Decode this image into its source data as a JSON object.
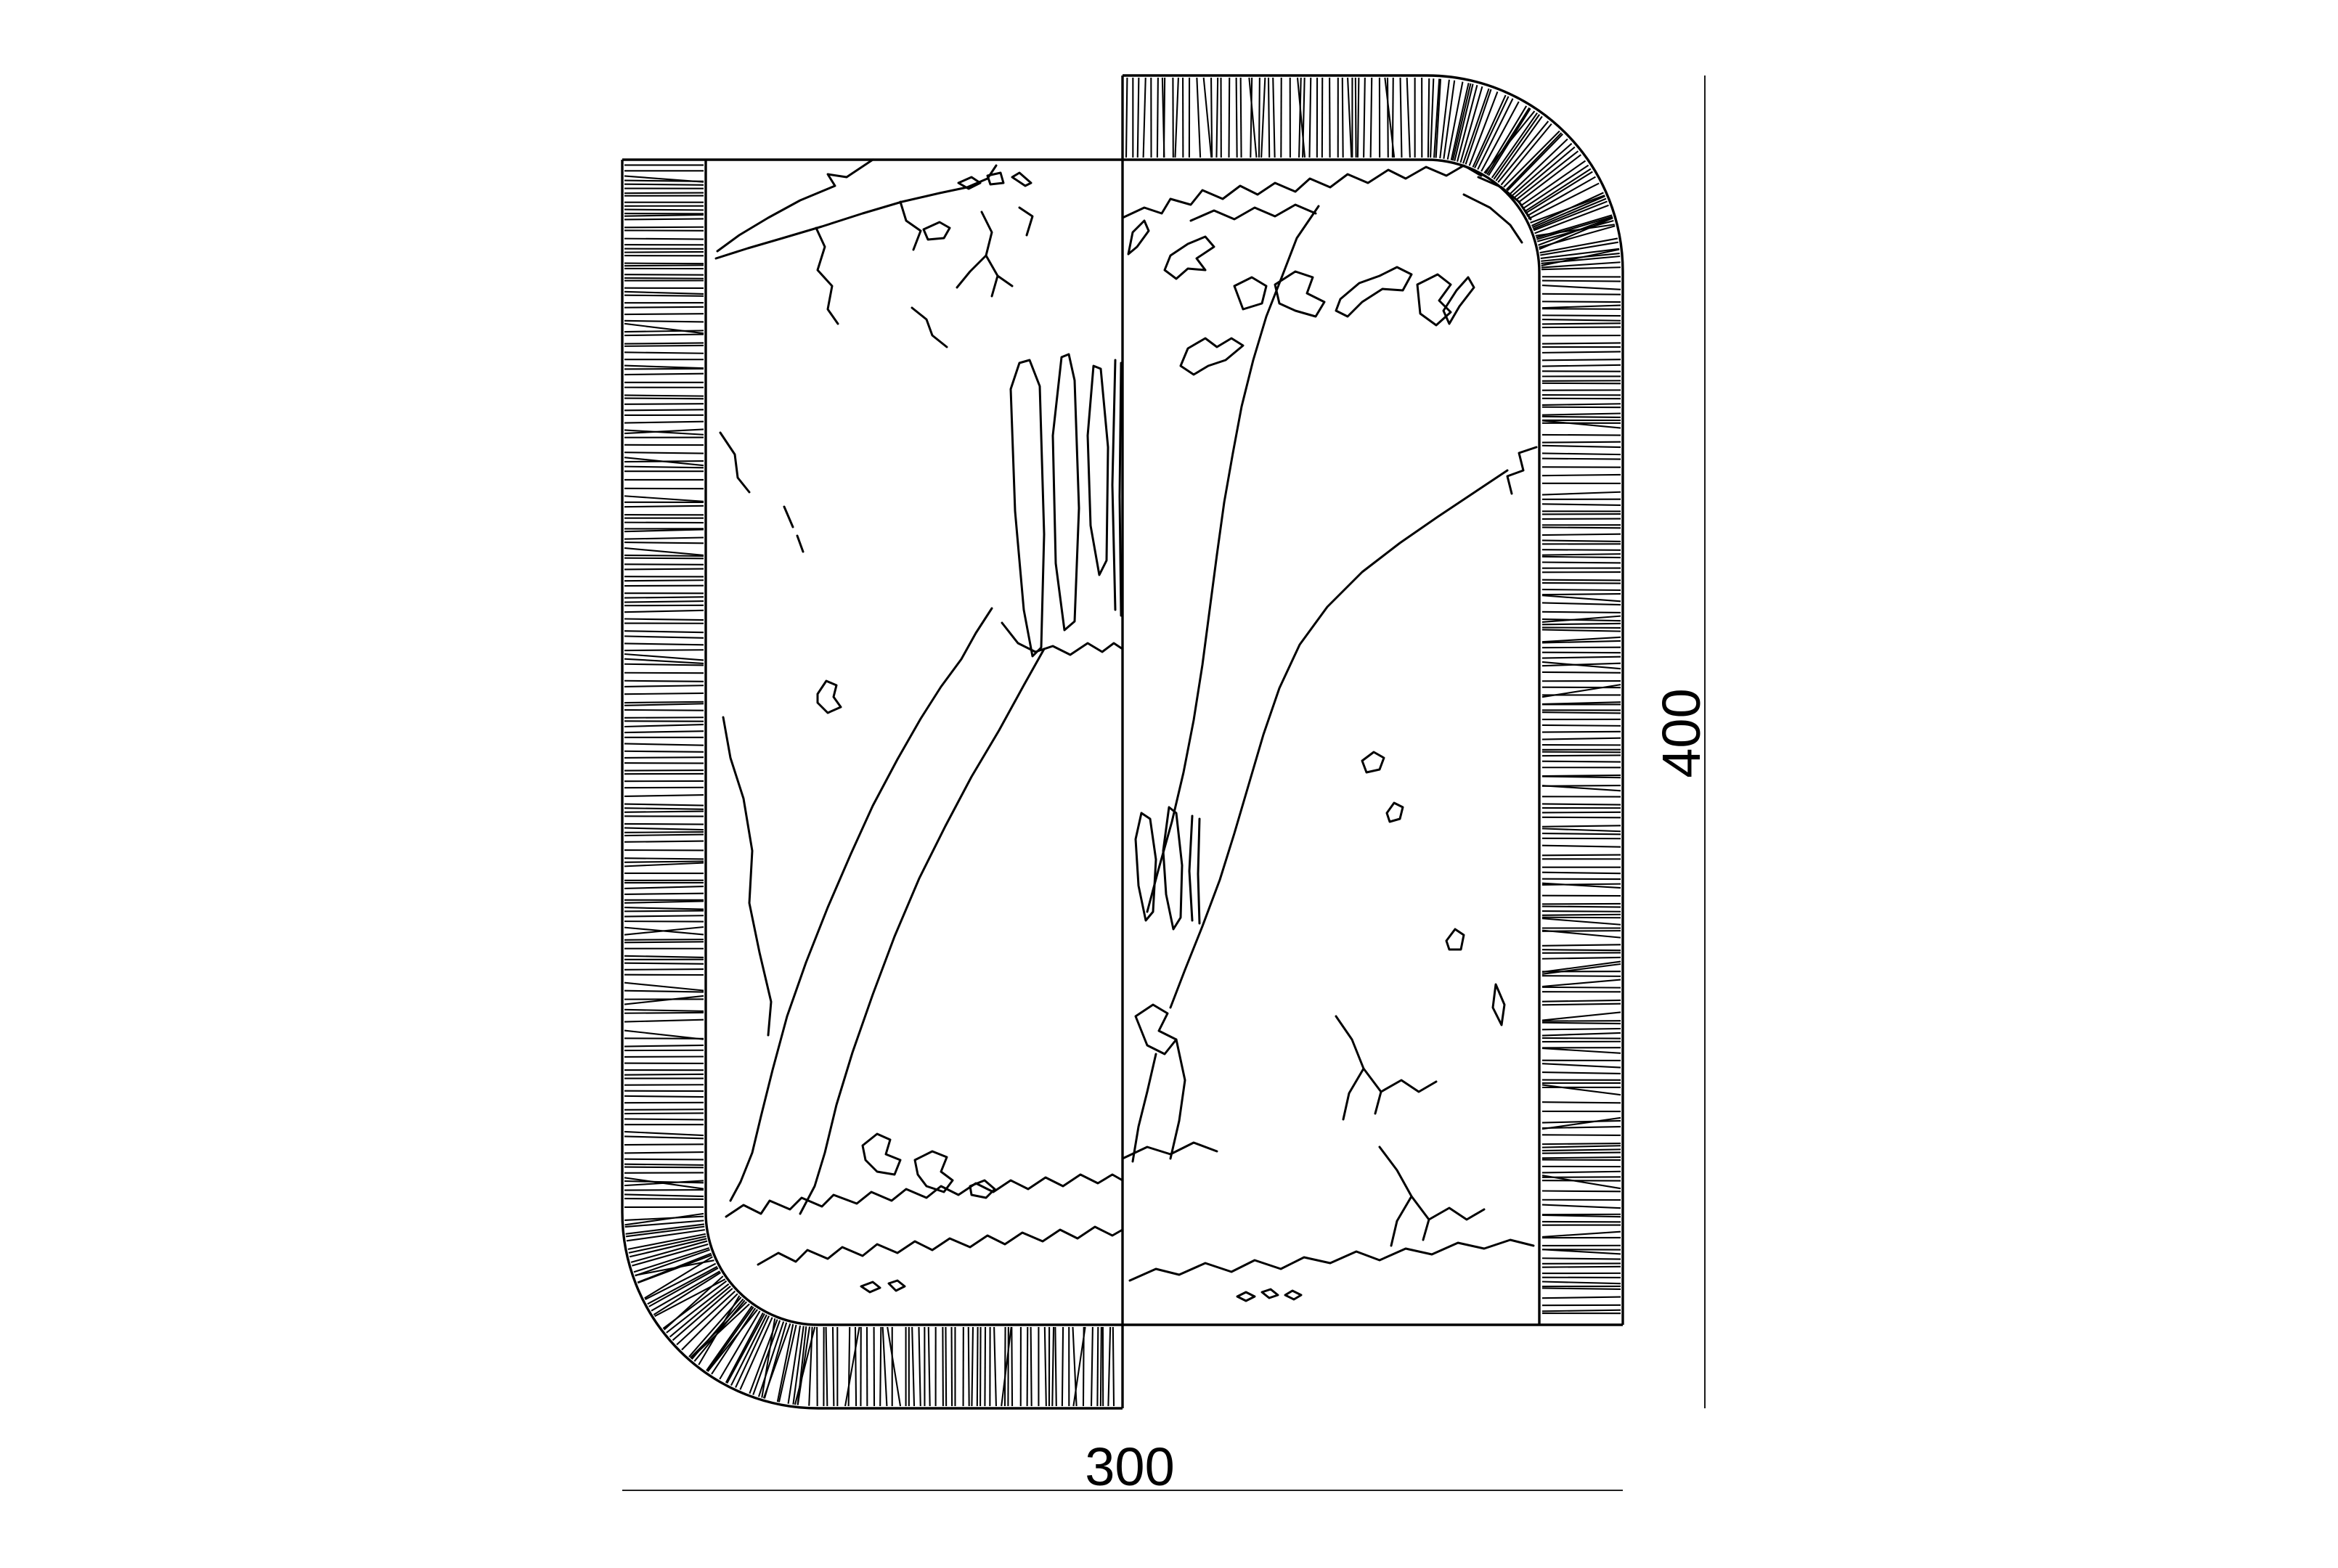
{
  "drawing": {
    "dimensions": {
      "width_label": "300",
      "height_label": "400"
    },
    "colors": {
      "line": "#000000",
      "background": "#ffffff"
    }
  }
}
